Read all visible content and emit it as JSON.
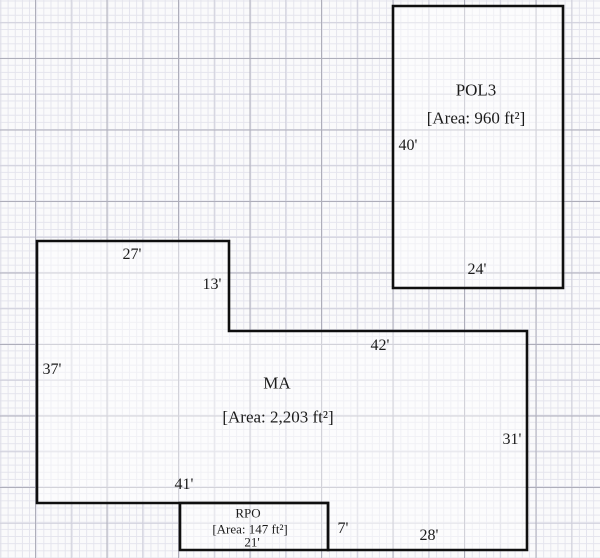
{
  "canvas": {
    "width": 600,
    "height": 558
  },
  "colors": {
    "paper": "#fafafb",
    "grid_minor": "#e4e4ed",
    "grid_medium": "#cfcfdb",
    "grid_major": "#aeaeba",
    "outline": "#0f0f0f",
    "shape_fill": "rgba(255,255,255,0.45)",
    "text": "#1b1b1b"
  },
  "shapes": [
    {
      "id": "pol3",
      "name": "POL3",
      "area_text": "[Area: 960 ft²]",
      "small": false,
      "points": [
        [
          393,
          6
        ],
        [
          563,
          6
        ],
        [
          563,
          288
        ],
        [
          393,
          288
        ]
      ],
      "labels": [
        {
          "role": "name",
          "text": "POL3",
          "x": 476,
          "y": 90
        },
        {
          "role": "area",
          "text": "[Area: 960 ft²]",
          "x": 476,
          "y": 118
        },
        {
          "role": "dim",
          "text": "40'",
          "x": 408,
          "y": 146
        },
        {
          "role": "dim",
          "text": "24'",
          "x": 477,
          "y": 270
        }
      ]
    },
    {
      "id": "ma",
      "name": "MA",
      "area_text": "[Area: 2,203 ft²]",
      "small": false,
      "points": [
        [
          37,
          241
        ],
        [
          229,
          241
        ],
        [
          229,
          331
        ],
        [
          527,
          331
        ],
        [
          527,
          550
        ],
        [
          328,
          550
        ],
        [
          328,
          503
        ],
        [
          37,
          503
        ]
      ],
      "labels": [
        {
          "role": "name",
          "text": "MA",
          "x": 277,
          "y": 383
        },
        {
          "role": "area",
          "text": "[Area: 2,203 ft²]",
          "x": 278,
          "y": 417
        },
        {
          "role": "dim",
          "text": "27'",
          "x": 132,
          "y": 255
        },
        {
          "role": "dim",
          "text": "13'",
          "x": 212,
          "y": 285
        },
        {
          "role": "dim",
          "text": "37'",
          "x": 52,
          "y": 370
        },
        {
          "role": "dim",
          "text": "42'",
          "x": 380,
          "y": 346
        },
        {
          "role": "dim",
          "text": "31'",
          "x": 512,
          "y": 440
        },
        {
          "role": "dim",
          "text": "41'",
          "x": 184,
          "y": 485
        },
        {
          "role": "dim",
          "text": "7'",
          "x": 343,
          "y": 529
        },
        {
          "role": "dim",
          "text": "28'",
          "x": 429,
          "y": 536
        }
      ]
    },
    {
      "id": "rpo",
      "name": "RPO",
      "area_text": "[Area: 147 ft²]",
      "small": true,
      "points": [
        [
          180,
          503
        ],
        [
          328,
          503
        ],
        [
          328,
          550
        ],
        [
          180,
          550
        ]
      ],
      "labels": [
        {
          "role": "name",
          "text": "RPO",
          "x": 248,
          "y": 513
        },
        {
          "role": "area",
          "text": "[Area: 147 ft²]",
          "x": 250,
          "y": 529
        },
        {
          "role": "dim",
          "text": "21'",
          "x": 252,
          "y": 542
        }
      ]
    }
  ]
}
